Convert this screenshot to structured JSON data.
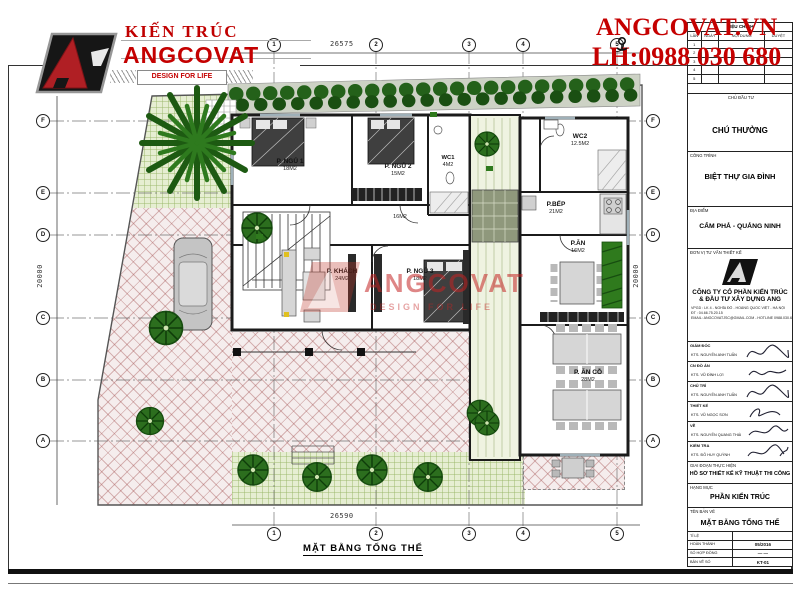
{
  "branding": {
    "brand_top": "KIẾN TRÚC",
    "brand_name": "ANGCOVAT",
    "tagline": "DESIGN FOR LIFE"
  },
  "contact": {
    "site": "ANGCOVAT.VN",
    "phone": "LH:0988 030 680"
  },
  "watermark": {
    "text": "ANGCOVAT",
    "tagline": "DESIGN FOR LIFE"
  },
  "plan": {
    "title": "MẶT BẰNG TỔNG THỂ",
    "dims": {
      "top": "26575",
      "bottom": "26590",
      "left": "20000",
      "right": "20000"
    },
    "grid_cols": [
      "1",
      "2",
      "3",
      "4",
      "5"
    ],
    "grid_rows": [
      "F",
      "E",
      "D",
      "C",
      "B",
      "A"
    ],
    "rooms": [
      {
        "name": "P. NGỦ 1",
        "area": "18M2"
      },
      {
        "name": "P. NGỦ 2",
        "area": "15M2"
      },
      {
        "name": "WC1",
        "area": "4M2"
      },
      {
        "name": "WC2",
        "area": "12.5M2"
      },
      {
        "name": "P.BẾP",
        "area": "21M2"
      },
      {
        "name": "P.ĂN",
        "area": "16M2"
      },
      {
        "name": "P. KHÁCH",
        "area": "24M2"
      },
      {
        "name": "P. NGỦ 3",
        "area": "18M2"
      },
      {
        "name": "P. ĂN CỖ",
        "area": "28M2"
      },
      {
        "name": "",
        "area": "16M2"
      }
    ]
  },
  "titleblock": {
    "revision": {
      "title": "HIỆU CHỈNH",
      "cols": [
        "LẦN",
        "NGÀY",
        "NỘI DUNG",
        "DUYỆT"
      ],
      "rows": [
        "1",
        "2",
        "3",
        "4",
        "5"
      ]
    },
    "investor_label": "CHỦ ĐẦU TƯ",
    "investor": "CHÚ THƯỞNG",
    "project_label": "CÔNG TRÌNH",
    "project": "BIỆT THỰ GIA ĐÌNH",
    "location_label": "ĐỊA ĐIỂM",
    "location": "CẨM PHẢ - QUẢNG NINH",
    "consultant_label": "ĐƠN VỊ TƯ VẤN THIẾT KẾ",
    "company_line1": "CÔNG TY CỔ PHẦN KIẾN TRÚC",
    "company_line2": "& ĐẦU TƯ XÂY DỰNG ANG",
    "info_line1": "VPGD :  LK 4 - NGHĨA ĐÔ - HOÀNG QUỐC VIỆT - HÀ NỘI",
    "info_line2": "ĐT     :  04.66.75.20.15",
    "info_line3": "EMAIL:  ANGCOVATJSC@GMAIL.COM - HOTLINE 0988.030.680",
    "signers": [
      {
        "role": "GIÁM ĐỐC",
        "name": "KTS. NGUYỄN ANH TUẤN"
      },
      {
        "role": "CN ĐỒ ÁN",
        "name": "KTS. VŨ ĐÌNH LỢI"
      },
      {
        "role": "CHỦ TRÌ",
        "name": "KTS. NGUYỄN ANH TUẤN"
      },
      {
        "role": "THIẾT KẾ",
        "name": "KTS. VŨ NGỌC SƠN"
      },
      {
        "role": "VẼ",
        "name": "KTS. NGUYỄN QUANG THÁI"
      },
      {
        "role": "KIỂM TRA",
        "name": "KTS. ĐỖ HUY QUỲNH"
      }
    ],
    "phase_label": "GIAI ĐOẠN THỰC HIỆN",
    "phase": "HỒ SƠ THIẾT KẾ KỸ THUẬT THI CÔNG",
    "category_label": "HẠNG MỤC",
    "category": "PHẦN KIẾN TRÚC",
    "drawing_label": "TÊN BẢN VẼ",
    "drawing": "MẶT BẰNG TỔNG THỂ",
    "meta": [
      {
        "label": "TỈ LỆ",
        "value": ""
      },
      {
        "label": "HOÀN THÀNH",
        "value": "05/2016"
      },
      {
        "label": "SỐ HỢP ĐỒNG",
        "value": "—   —"
      },
      {
        "label": "BẢN VẼ SỐ",
        "value": "KT-01"
      }
    ]
  }
}
